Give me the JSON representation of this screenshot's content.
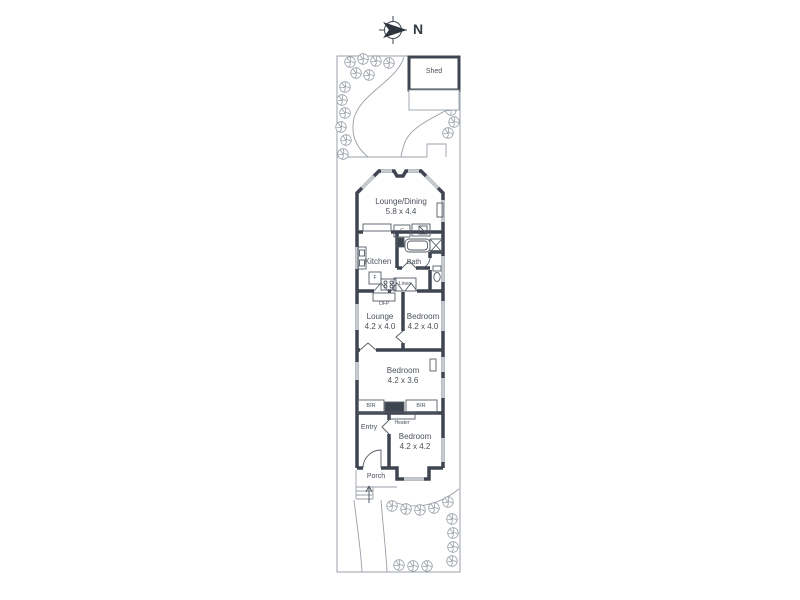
{
  "plan": {
    "compass_label": "N",
    "shed_label": "Shed",
    "rooms": {
      "lounge_dining": {
        "name": "Lounge/Dining",
        "dims": "5.8 x 4.4"
      },
      "kitchen": {
        "name": "Kitchen"
      },
      "bath": {
        "name": "Bath"
      },
      "lounge": {
        "name": "Lounge",
        "dims": "4.2 x 4.0"
      },
      "bedroom_rear": {
        "name": "Bedroom",
        "dims": "4.2 x 4.0"
      },
      "bedroom_middle": {
        "name": "Bedroom",
        "dims": "4.2 x 3.6"
      },
      "bedroom_front": {
        "name": "Bedroom",
        "dims": "4.2 x 4.2"
      },
      "entry": {
        "name": "Entry"
      },
      "porch": {
        "name": "Porch"
      }
    },
    "fixtures": {
      "cupboard": "C",
      "fridge": "F",
      "linen": "Linen",
      "fireplace": "OFP",
      "robe_left": "BIR",
      "robe_right": "BIR",
      "heater": "Heater"
    },
    "colors": {
      "wall": "#3e4550",
      "thin_line": "#9aa1a9",
      "window": "#c6cacf",
      "text": "#4a515a"
    }
  }
}
